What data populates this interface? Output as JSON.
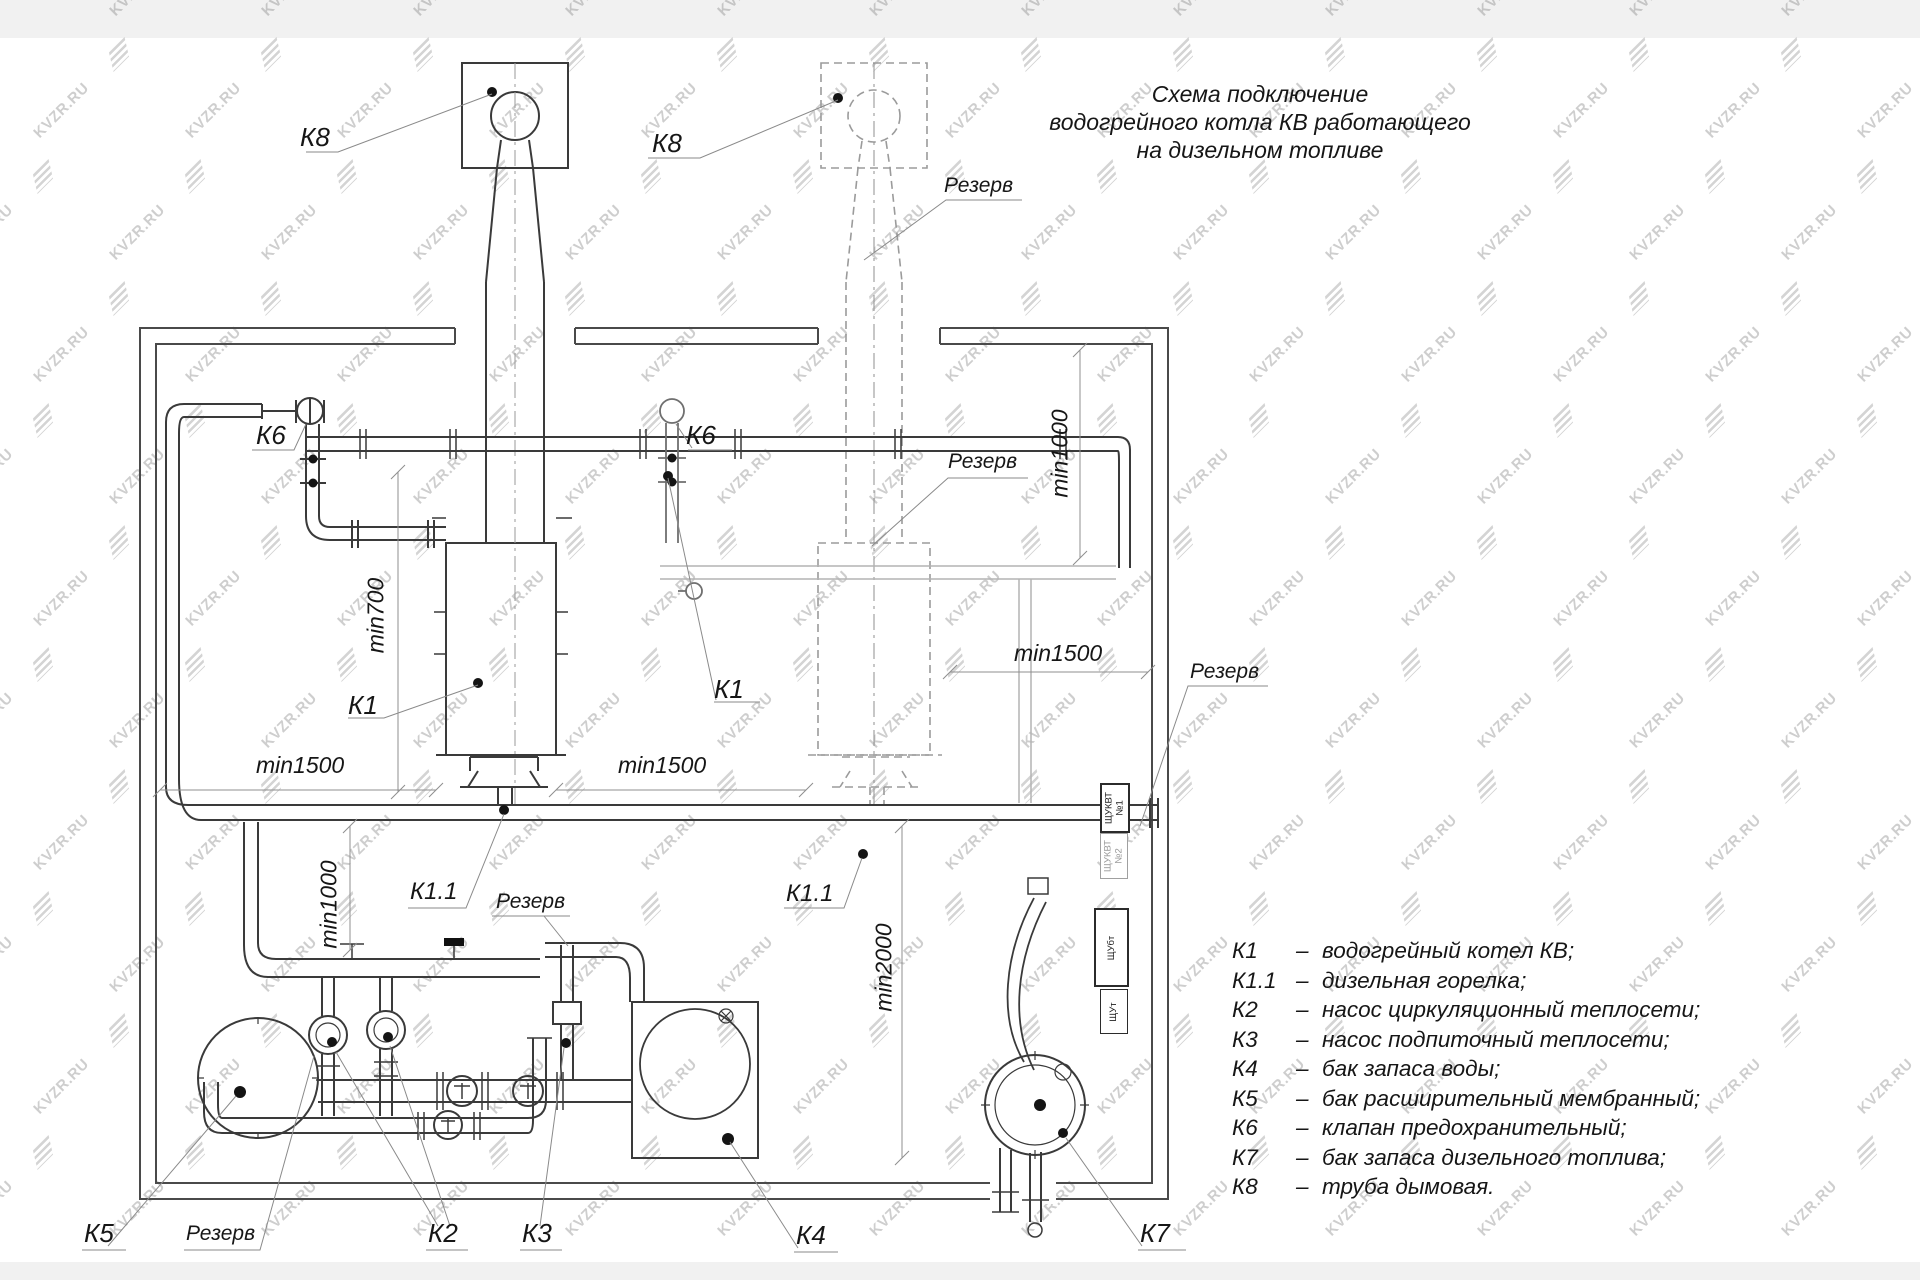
{
  "watermark": {
    "text": "KVZR.RU"
  },
  "title": {
    "line1": "Схема подключение",
    "line2": "водогрейного котла КВ работающего",
    "line3": "на дизельном топливе"
  },
  "labels": {
    "k8_left": "К8",
    "k8_right": "К8",
    "k6_left": "К6",
    "k6_right": "К6",
    "k1_left": "К1",
    "k1_right": "К1",
    "k11_left": "К1.1",
    "k11_right": "К1.1",
    "k2": "К2",
    "k3": "К3",
    "k4": "К4",
    "k5": "К5",
    "k7": "К7",
    "rezerv_chimney": "Резерв",
    "rezerv_boiler_top": "Резерв",
    "rezerv_right": "Резерв",
    "rezerv_burner": "Резерв",
    "rezerv_pump": "Резерв"
  },
  "dimensions": {
    "min700": "min700",
    "min1000_top": "min1000",
    "min1000_bottom": "min1000",
    "min1500_left": "min1500",
    "min1500_center": "min1500",
    "min1500_right": "min1500",
    "min2000": "min2000"
  },
  "panels": {
    "p1": {
      "line1": "ЩУКВТ",
      "line2": "№1"
    },
    "p2": {
      "line1": "ЩУКВТ",
      "line2": "№2"
    },
    "p3": {
      "line1": "ЩУбт",
      "line2": ""
    },
    "p4": {
      "line1": "ЩУт",
      "line2": ""
    }
  },
  "legend": {
    "dash": "–",
    "items": [
      {
        "code": "К1",
        "desc": "водогрейный котел КВ;"
      },
      {
        "code": "К1.1",
        "desc": "дизельная горелка;"
      },
      {
        "code": "К2",
        "desc": "насос циркуляционный теплосети;"
      },
      {
        "code": "К3",
        "desc": "насос подпиточный теплосети;"
      },
      {
        "code": "К4",
        "desc": "бак запаса воды;"
      },
      {
        "code": "К5",
        "desc": "бак расширительный мембранный;"
      },
      {
        "code": "К6",
        "desc": "клапан предохранительный;"
      },
      {
        "code": "К7",
        "desc": "бак запаса дизельного топлива;"
      },
      {
        "code": "К8",
        "desc": "труба дымовая."
      }
    ]
  },
  "colors": {
    "line": "#3a3a3a",
    "reserve_line": "#9b9b9b",
    "leader": "#8a8a8a",
    "watermark": "#8f8f8f"
  }
}
